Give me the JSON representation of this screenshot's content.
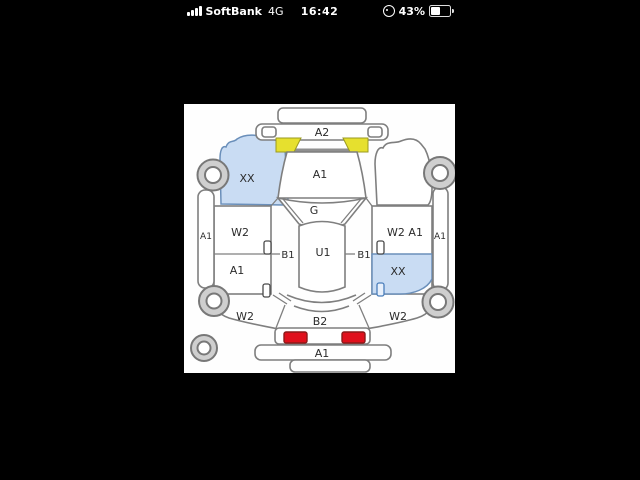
{
  "status_bar": {
    "carrier": "SoftBank",
    "network": "4G",
    "time": "16:42",
    "battery_percent": "43%"
  },
  "diagram": {
    "type": "vehicle-inspection-damage-map",
    "colors": {
      "highlight_blue": "#c9dcf3",
      "highlight_blue_stroke": "#6a8fba",
      "highlight_yellow": "#e6e02e",
      "highlight_yellow_stroke": "#9a9a20",
      "tail_light_red": "#e0101c",
      "tail_light_stroke": "#8b1a1a"
    },
    "panels": {
      "front_garnish": "A2",
      "hood": "A1",
      "left_front_fender": "XX",
      "windshield": "G",
      "roof": "U1",
      "left_pillar": "B1",
      "right_pillar": "B1",
      "left_front_door": "W2",
      "left_rear_door": "A1",
      "left_sill": "A1",
      "right_front_door": "W2 A1",
      "right_rear_door": "XX",
      "right_sill": "A1",
      "left_quarter_panel": "W2",
      "back_panel": "B2",
      "right_quarter_panel": "W2",
      "rear_bumper": "A1"
    }
  }
}
